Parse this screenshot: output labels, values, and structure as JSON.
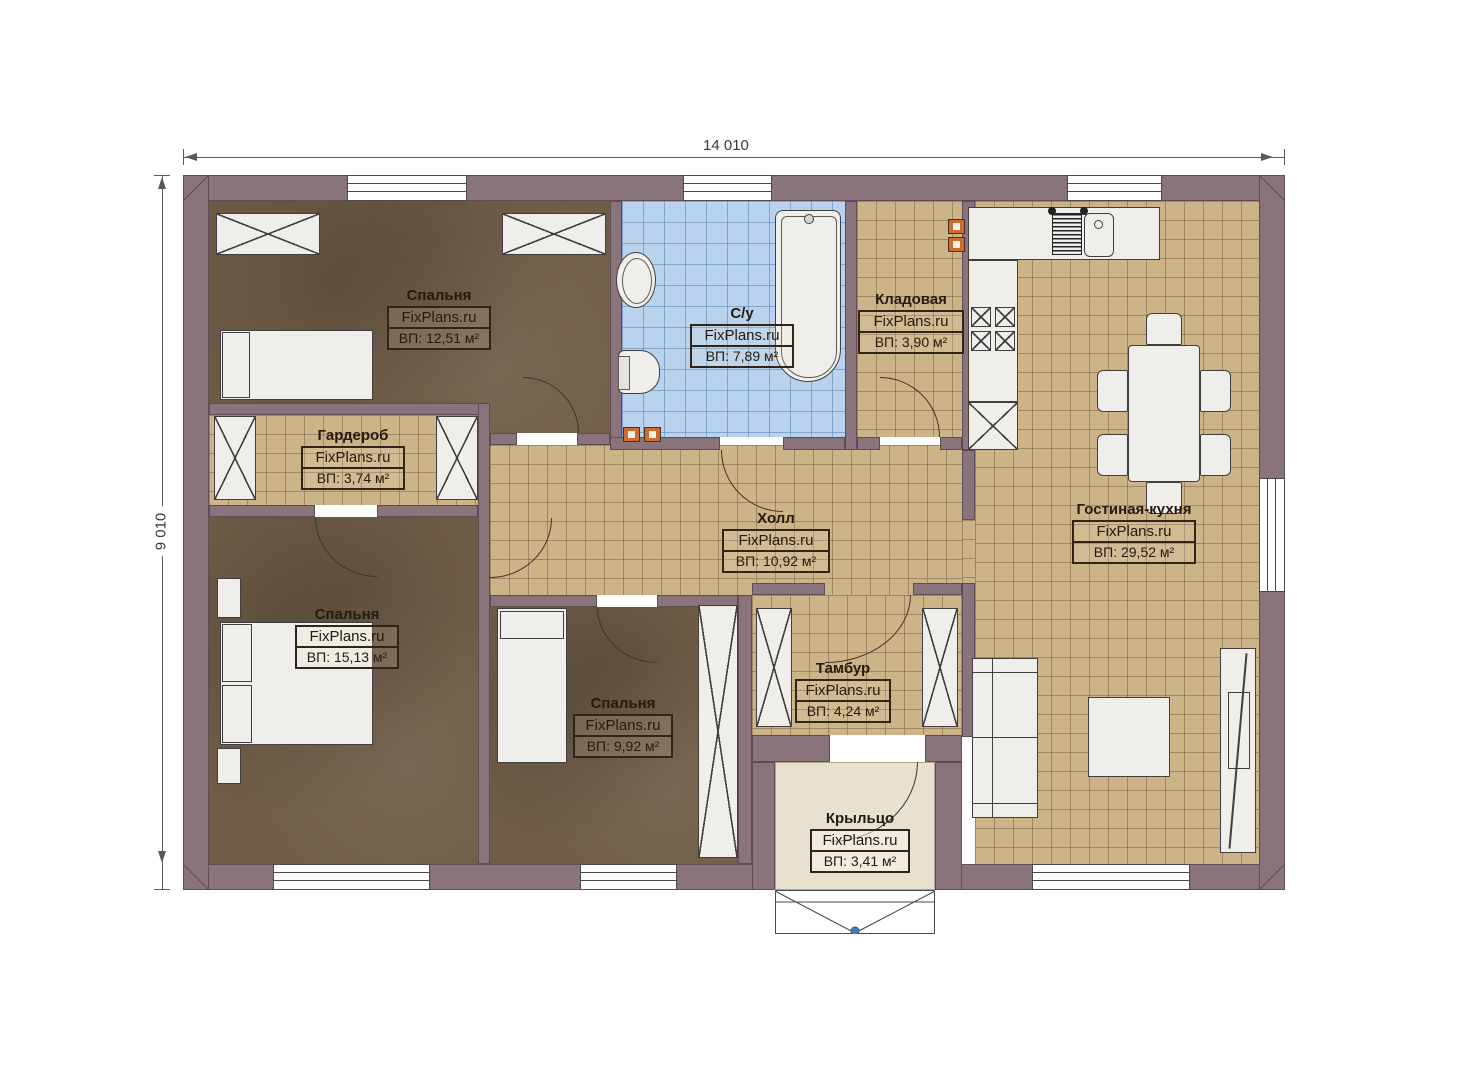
{
  "watermark": "FixPlans.ru",
  "dimensions": {
    "width_mm": "14 010",
    "height_mm": "9 010"
  },
  "rooms": [
    {
      "name": "Спальня",
      "area": "ВП: 12,51 м²"
    },
    {
      "name": "С/у",
      "area": "ВП: 7,89 м²"
    },
    {
      "name": "Кладовая",
      "area": "ВП: 3,90 м²"
    },
    {
      "name": "Гардероб",
      "area": "ВП: 3,74 м²"
    },
    {
      "name": "Холл",
      "area": "ВП: 10,92 м²"
    },
    {
      "name": "Гостиная-кухня",
      "area": "ВП: 29,52 м²"
    },
    {
      "name": "Спальня",
      "area": "ВП: 15,13 м²"
    },
    {
      "name": "Спальня",
      "area": "ВП: 9,92 м²"
    },
    {
      "name": "Тамбур",
      "area": "ВП: 4,24 м²"
    },
    {
      "name": "Крыльцо",
      "area": "ВП: 3,41 м²"
    }
  ],
  "colors": {
    "wall": "#89747b",
    "bedroom_floor": "#6f5d47",
    "tile_floor": "#cdb388",
    "bathroom_floor": "#b9d3ee",
    "porch_floor": "#e9e1cf",
    "accent_orange": "#cf6b2c"
  }
}
